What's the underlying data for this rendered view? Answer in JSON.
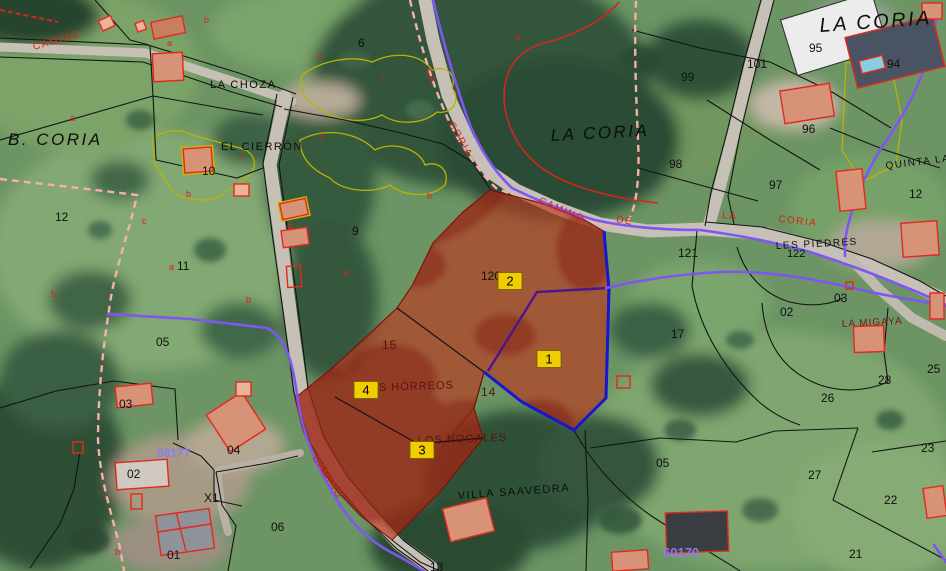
{
  "map": {
    "description": "Aerial cadastral map with highlighted selection parcels",
    "colors": {
      "selection_fill": "#bb3a20",
      "selection_mottle": "#7e150b",
      "marker_fill": "#f0cd00",
      "marker_border": "#6b5d00",
      "boundary_purple": "#7e57f2",
      "boundary_dark_purple": "#4a1791",
      "boundary_blue": "#1518cf",
      "admin_pink": "#f6b0a8",
      "boundary_red": "#d5261a",
      "road_label_red": "#d82318",
      "admin_label_purple": "#8a7cf2"
    },
    "parcel_markers": [
      {
        "label": "1",
        "x": 549,
        "y": 359
      },
      {
        "label": "2",
        "x": 510,
        "y": 281
      },
      {
        "label": "3",
        "x": 422,
        "y": 450
      },
      {
        "label": "4",
        "x": 366,
        "y": 390
      }
    ],
    "labels": [
      {
        "n": "zone-b-coria",
        "t": "B. CORIA",
        "x": 8,
        "y": 145,
        "c": "big",
        "s": 17
      },
      {
        "n": "zone-la-coria-center",
        "t": "LA CORIA",
        "x": 551,
        "y": 141,
        "c": "big",
        "s": 17,
        "r": -3
      },
      {
        "n": "zone-la-coria-ne",
        "t": "LA CORIA",
        "x": 820,
        "y": 32,
        "c": "big",
        "s": 20,
        "r": -4
      },
      {
        "n": "place-la-choza",
        "t": "LA CHOZA",
        "x": 210,
        "y": 88,
        "c": "place",
        "s": 11
      },
      {
        "n": "place-el-cierron",
        "t": "EL CIERRÓN",
        "x": 221,
        "y": 150,
        "c": "place",
        "s": 11
      },
      {
        "n": "place-les-piedres",
        "t": "LES PIEDRES",
        "x": 776,
        "y": 249,
        "c": "place",
        "s": 10,
        "r": -3
      },
      {
        "n": "place-quinta-la-x",
        "t": "QUINTA LA X",
        "x": 886,
        "y": 169,
        "c": "place",
        "s": 10,
        "r": -7
      },
      {
        "n": "place-villa-saavedra",
        "t": "VILLA SAAVEDRA",
        "x": 458,
        "y": 499,
        "c": "place",
        "s": 11,
        "r": -4
      },
      {
        "n": "place-la-migaya",
        "t": "LA MIGAYA",
        "x": 842,
        "y": 327,
        "c": "mig",
        "s": 10,
        "r": -3
      },
      {
        "n": "place-los-nogales",
        "t": "LOS NOGALES",
        "x": 418,
        "y": 444,
        "c": "dkr",
        "s": 11,
        "r": -2
      },
      {
        "n": "place-horreos",
        "t": "S HÓRREOS",
        "x": 379,
        "y": 391,
        "c": "dkr",
        "s": 11,
        "r": -2
      },
      {
        "n": "admin-60170",
        "t": "60170",
        "x": 663,
        "y": 557,
        "c": "adm",
        "s": 13
      },
      {
        "n": "admin-58177",
        "t": "58177",
        "x": 157,
        "y": 457,
        "c": "adm",
        "s": 12
      },
      {
        "n": "road-camino-nw",
        "t": "CAMINO",
        "x": 34,
        "y": 50,
        "c": "road",
        "s": 10,
        "r": -16
      },
      {
        "n": "road-la-1",
        "t": "LA",
        "x": 426,
        "y": 70,
        "c": "road",
        "s": 10,
        "r": 72
      },
      {
        "n": "road-coria-1",
        "t": "CORIA",
        "x": 448,
        "y": 124,
        "c": "road",
        "s": 10,
        "r": 60
      },
      {
        "n": "road-camino-mid",
        "t": "CAMINO",
        "x": 538,
        "y": 203,
        "c": "road",
        "s": 10,
        "r": 23
      },
      {
        "n": "road-de",
        "t": "DE",
        "x": 616,
        "y": 222,
        "c": "road",
        "s": 10,
        "r": 10
      },
      {
        "n": "road-la-2",
        "t": "LA",
        "x": 722,
        "y": 218,
        "c": "road",
        "s": 10,
        "r": 4
      },
      {
        "n": "road-coria-2",
        "t": "CORIA",
        "x": 778,
        "y": 222,
        "c": "road",
        "s": 10,
        "r": 6
      },
      {
        "n": "road-camino-sw",
        "t": "CAMINO",
        "x": 312,
        "y": 458,
        "c": "road",
        "s": 10,
        "r": 58
      },
      {
        "n": "pnum-6",
        "t": "6",
        "x": 358,
        "y": 47,
        "c": "pnum",
        "s": 12
      },
      {
        "n": "pnum-9",
        "t": "9",
        "x": 352,
        "y": 235,
        "c": "pnum",
        "s": 12
      },
      {
        "n": "pnum-10",
        "t": "10",
        "x": 202,
        "y": 175,
        "c": "pnum",
        "s": 12
      },
      {
        "n": "pnum-12-w",
        "t": "12",
        "x": 55,
        "y": 221,
        "c": "pnum",
        "s": 12
      },
      {
        "n": "pnum-11",
        "t": "11",
        "x": 177,
        "y": 270,
        "c": "pnum",
        "s": 12
      },
      {
        "n": "pnum-05-w",
        "t": "05",
        "x": 156,
        "y": 346,
        "c": "pnum",
        "s": 12
      },
      {
        "n": "pnum-03-w",
        "t": "03",
        "x": 119,
        "y": 408,
        "c": "pnum",
        "s": 12
      },
      {
        "n": "pnum-02-w",
        "t": "02",
        "x": 127,
        "y": 478,
        "c": "pnum",
        "s": 12
      },
      {
        "n": "pnum-04",
        "t": "04",
        "x": 227,
        "y": 454,
        "c": "pnum",
        "s": 12
      },
      {
        "n": "pnum-x1",
        "t": "X1",
        "x": 204,
        "y": 502,
        "c": "pnum",
        "s": 12
      },
      {
        "n": "pnum-06",
        "t": "06",
        "x": 271,
        "y": 531,
        "c": "pnum",
        "s": 12
      },
      {
        "n": "pnum-01",
        "t": "01",
        "x": 167,
        "y": 559,
        "c": "pnum",
        "s": 12
      },
      {
        "n": "pnum-13",
        "t": "13",
        "x": 430,
        "y": 571,
        "c": "pnum",
        "s": 12
      },
      {
        "n": "pnum-120",
        "t": "120",
        "x": 481,
        "y": 280,
        "c": "pnum",
        "s": 12
      },
      {
        "n": "pnum-15",
        "t": "15",
        "x": 382,
        "y": 349,
        "c": "dkr",
        "s": 12
      },
      {
        "n": "pnum-14",
        "t": "14",
        "x": 481,
        "y": 396,
        "c": "dkr",
        "s": 12
      },
      {
        "n": "pnum-121",
        "t": "121",
        "x": 678,
        "y": 257,
        "c": "pnum",
        "s": 12
      },
      {
        "n": "pnum-122",
        "t": "122",
        "x": 787,
        "y": 257,
        "c": "pnum",
        "s": 11
      },
      {
        "n": "pnum-17",
        "t": "17",
        "x": 671,
        "y": 338,
        "c": "pnum",
        "s": 12
      },
      {
        "n": "pnum-02-e",
        "t": "02",
        "x": 780,
        "y": 316,
        "c": "pnum",
        "s": 12
      },
      {
        "n": "pnum-03-e",
        "t": "03",
        "x": 834,
        "y": 302,
        "c": "pnum",
        "s": 12
      },
      {
        "n": "pnum-28",
        "t": "28",
        "x": 878,
        "y": 384,
        "c": "pnum",
        "s": 12
      },
      {
        "n": "pnum-26",
        "t": "26",
        "x": 821,
        "y": 402,
        "c": "pnum",
        "s": 12
      },
      {
        "n": "pnum-25",
        "t": "25",
        "x": 927,
        "y": 373,
        "c": "pnum",
        "s": 12
      },
      {
        "n": "pnum-27",
        "t": "27",
        "x": 808,
        "y": 479,
        "c": "pnum",
        "s": 12
      },
      {
        "n": "pnum-22",
        "t": "22",
        "x": 884,
        "y": 504,
        "c": "pnum",
        "s": 12
      },
      {
        "n": "pnum-23",
        "t": "23",
        "x": 921,
        "y": 452,
        "c": "pnum",
        "s": 12
      },
      {
        "n": "pnum-21",
        "t": "21",
        "x": 849,
        "y": 558,
        "c": "pnum",
        "s": 12
      },
      {
        "n": "pnum-05-e",
        "t": "05",
        "x": 656,
        "y": 467,
        "c": "pnum",
        "s": 12
      },
      {
        "n": "pnum-95",
        "t": "95",
        "x": 809,
        "y": 52,
        "c": "pnum",
        "s": 12
      },
      {
        "n": "pnum-94",
        "t": "94",
        "x": 887,
        "y": 68,
        "c": "pnum",
        "s": 12
      },
      {
        "n": "pnum-96",
        "t": "96",
        "x": 802,
        "y": 133,
        "c": "pnum",
        "s": 12
      },
      {
        "n": "pnum-97",
        "t": "97",
        "x": 769,
        "y": 189,
        "c": "pnum",
        "s": 12
      },
      {
        "n": "pnum-98",
        "t": "98",
        "x": 669,
        "y": 168,
        "c": "pnum",
        "s": 12
      },
      {
        "n": "pnum-99",
        "t": "99",
        "x": 681,
        "y": 81,
        "c": "pnum",
        "s": 12
      },
      {
        "n": "pnum-101",
        "t": "101",
        "x": 747,
        "y": 68,
        "c": "pnum",
        "s": 12
      },
      {
        "n": "pnum-12-e",
        "t": "12",
        "x": 909,
        "y": 198,
        "c": "pnum",
        "s": 12
      },
      {
        "n": "rl-a1",
        "t": "a",
        "x": 167,
        "y": 46,
        "c": "rl",
        "s": 9
      },
      {
        "n": "rl-b1",
        "t": "b",
        "x": 204,
        "y": 23,
        "c": "rl",
        "s": 9
      },
      {
        "n": "rl-a2",
        "t": "a",
        "x": 70,
        "y": 121,
        "c": "rl",
        "s": 9
      },
      {
        "n": "rl-c1",
        "t": "c",
        "x": 239,
        "y": 159,
        "c": "rl",
        "s": 9
      },
      {
        "n": "rl-b2",
        "t": "b",
        "x": 186,
        "y": 197,
        "c": "rl",
        "s": 9
      },
      {
        "n": "rl-c2",
        "t": "c",
        "x": 142,
        "y": 224,
        "c": "rl",
        "s": 9
      },
      {
        "n": "rl-b3",
        "t": "b",
        "x": 51,
        "y": 297,
        "c": "rl",
        "s": 9
      },
      {
        "n": "rl-d1",
        "t": "d",
        "x": 287,
        "y": 229,
        "c": "rl",
        "s": 9
      },
      {
        "n": "rl-b4",
        "t": "b",
        "x": 246,
        "y": 303,
        "c": "rl",
        "s": 9
      },
      {
        "n": "rl-a3",
        "t": "a",
        "x": 317,
        "y": 60,
        "c": "rl",
        "s": 9
      },
      {
        "n": "rl-c3",
        "t": "c",
        "x": 381,
        "y": 82,
        "c": "rl",
        "s": 9
      },
      {
        "n": "rl-c4",
        "t": "c",
        "x": 320,
        "y": 140,
        "c": "rl",
        "s": 9
      },
      {
        "n": "rl-b5",
        "t": "b",
        "x": 427,
        "y": 199,
        "c": "rl",
        "s": 9
      },
      {
        "n": "rl-b6",
        "t": "b",
        "x": 516,
        "y": 40,
        "c": "rl",
        "s": 9
      },
      {
        "n": "rl-a4",
        "t": "a",
        "x": 344,
        "y": 275,
        "c": "rl",
        "s": 9
      },
      {
        "n": "rl-a5",
        "t": "a",
        "x": 169,
        "y": 270,
        "c": "rl",
        "s": 9
      },
      {
        "n": "rl-b7",
        "t": "b",
        "x": 115,
        "y": 555,
        "c": "rl",
        "s": 9
      }
    ]
  }
}
